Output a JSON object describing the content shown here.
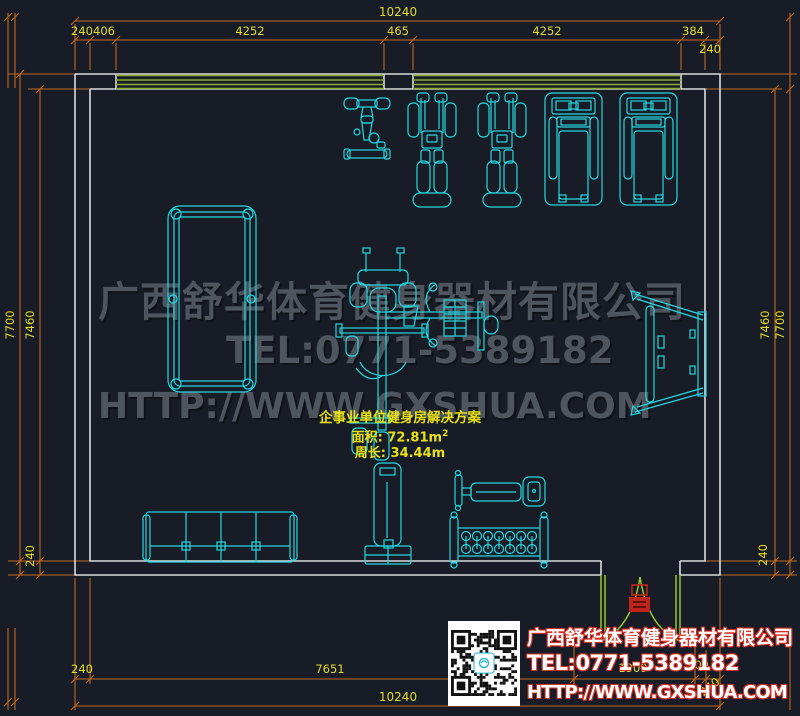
{
  "colors": {
    "background": "#171c26",
    "wall": "#d9dcdf",
    "equipment": "#25d7e0",
    "dimension_line": "#bf6820",
    "dimension_text": "#e3dc2a",
    "window": "#8cab31",
    "door": "#95c631",
    "door_symbol": "#c0251c",
    "watermark": "#4f555e",
    "annotation": "#e8e018",
    "footer_outline": "#d93025"
  },
  "dims": {
    "top_total": "10240",
    "t1": "240",
    "t2": "406",
    "t3": "4252",
    "t4": "465",
    "t5": "4252",
    "t6": "384",
    "t7": "240",
    "left_outer": "7700",
    "left_inner": "7460",
    "left_bottom": "240",
    "right_inner": "7460",
    "right_outer": "7700",
    "right_bottom": "240",
    "b1": "240",
    "b2": "7651",
    "b3": "1909",
    "b4": "200",
    "b5": "240",
    "bottom_total": "10240"
  },
  "annotation": {
    "title": "企事业单位健身房解决方案",
    "area": "面积: 72.81m",
    "area_sup": "2",
    "perimeter": "周长: 34.44m"
  },
  "watermark": {
    "company": "广西舒华体育健身器材有限公司",
    "tel": "TEL:0771-5389182",
    "web": "HTTP://WWW.GXSHUA.COM"
  },
  "footer": {
    "company": "广西舒华体育健身器材有限公司",
    "tel": "TEL:0771-5389182",
    "web": "HTTP://WWW.GXSHUA.COM"
  }
}
